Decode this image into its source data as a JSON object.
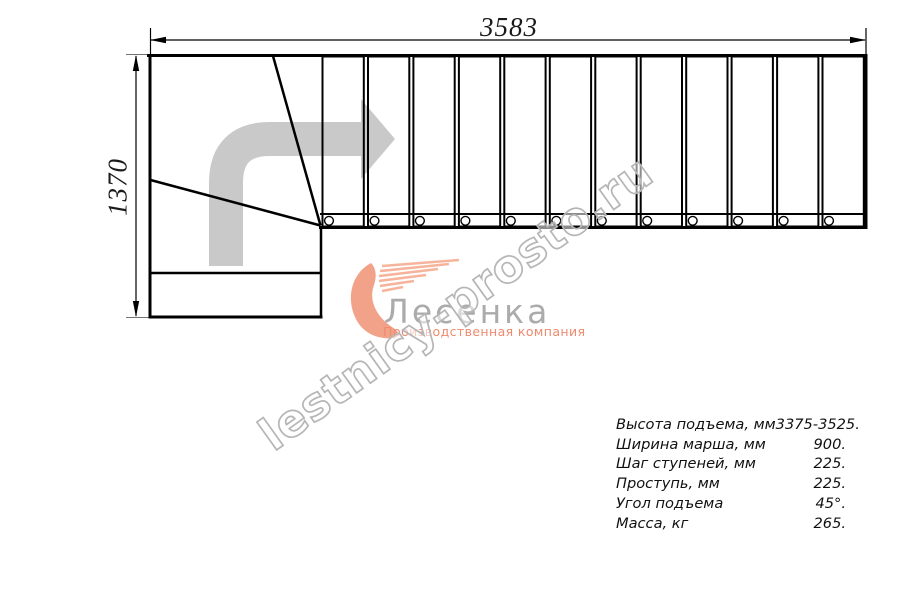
{
  "drawing": {
    "top_dimension": "3583",
    "left_dimension": "1370"
  },
  "stairs": {
    "straight_treads": 12,
    "winder_steps": 2,
    "turn": "90-degree left-to-right, direction arrow up then right"
  },
  "logo": {
    "name": "Лесенка",
    "subtitle": "Производственная компания"
  },
  "watermark": {
    "text": "lestnicy-prosto.ru"
  },
  "specs": {
    "rows": [
      {
        "label": "Высота подъема, мм",
        "value": "3375-3525."
      },
      {
        "label": "Ширина марша, мм",
        "value": "900."
      },
      {
        "label": "Шаг ступеней, мм",
        "value": "225."
      },
      {
        "label": "Проступь, мм",
        "value": "225."
      },
      {
        "label": "Угол подъема",
        "value": "45°."
      },
      {
        "label": "Масса, кг",
        "value": "265."
      }
    ]
  },
  "colors": {
    "line": "#000000",
    "arrow_gray": "#c9c9c9",
    "logo_accent": "#f2a289",
    "logo_accent_light": "#f5b49b",
    "logo_text_gray": "#ababab",
    "subtitle_salmon": "#ee8a6e",
    "watermark_gray": "#b6b6b6"
  }
}
